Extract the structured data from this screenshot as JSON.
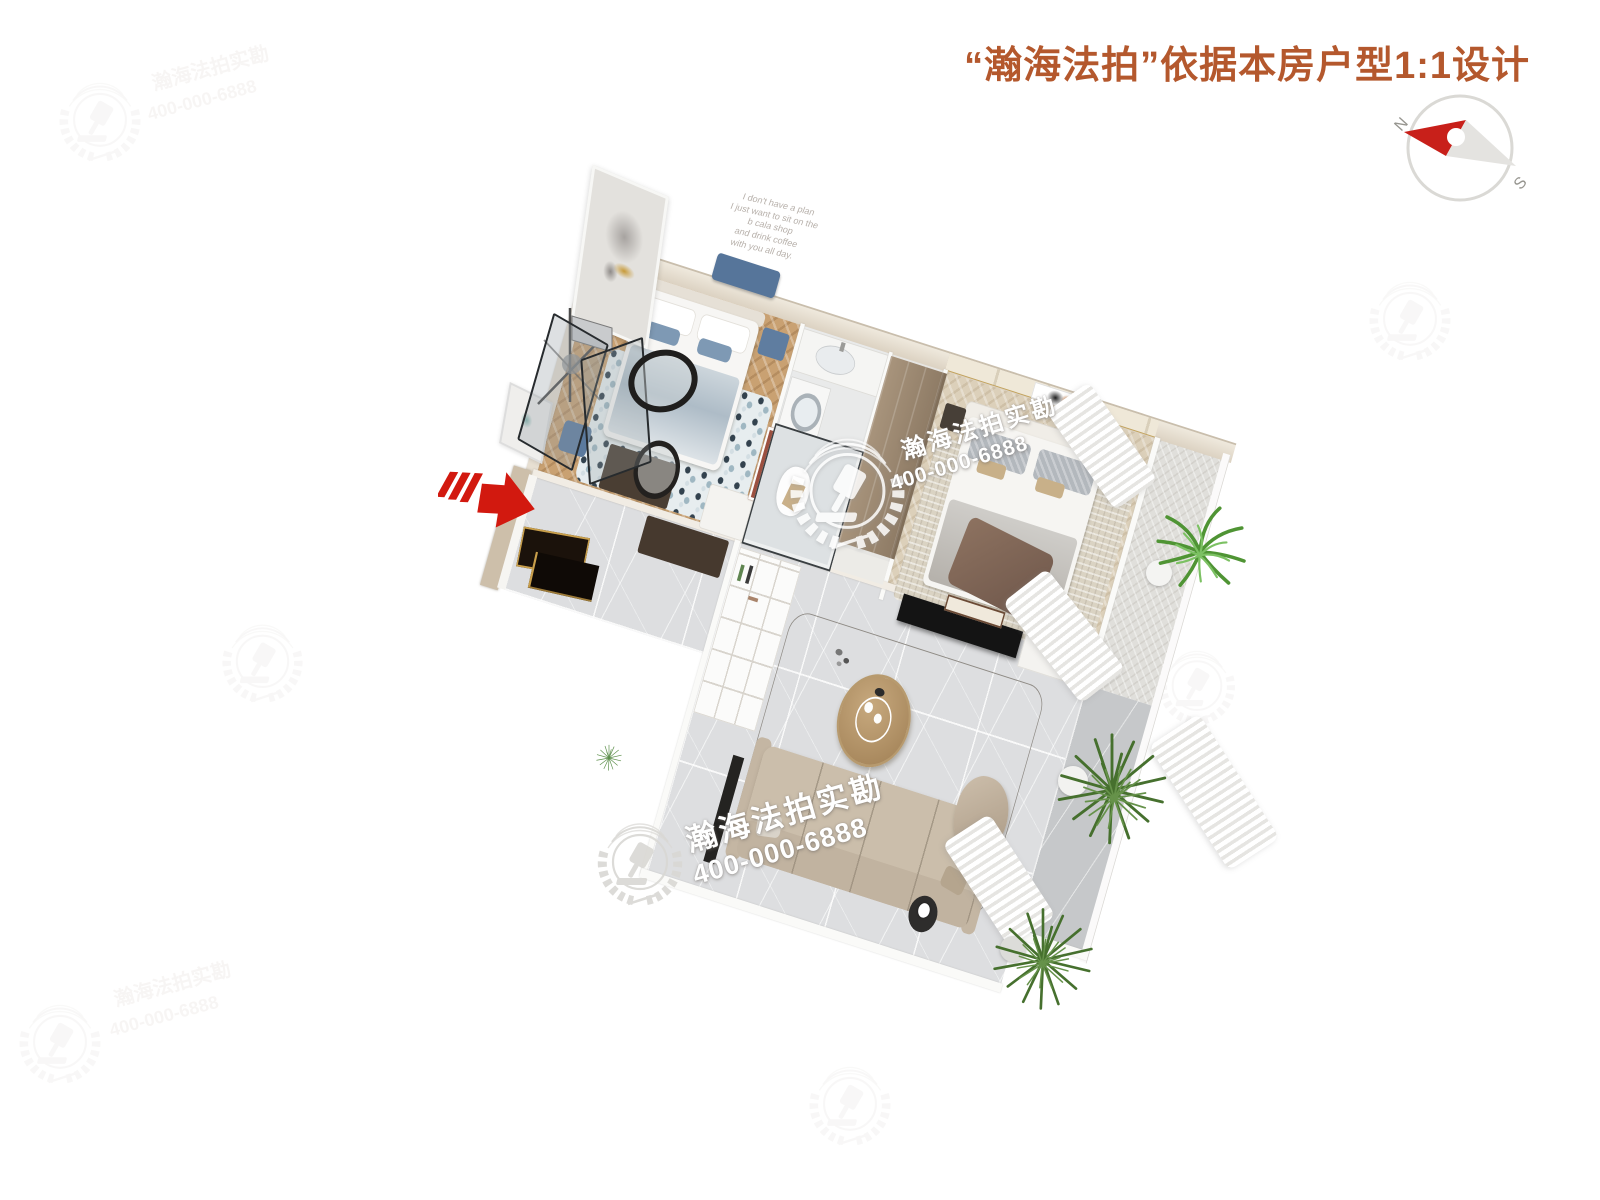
{
  "header": {
    "title": "“瀚海法拍”依据本房户型1:1设计"
  },
  "compass": {
    "north": "N",
    "south": "S"
  },
  "watermark": {
    "brand": "瀚海法拍实勘",
    "phone": "400-000-6888",
    "logo_icon": "gavel-laurel-wreath"
  },
  "wall_quote": {
    "lines": [
      "I don't have a plan",
      "I just want to sit on the",
      "b cala shop",
      "and drink coffee",
      "with you all day."
    ]
  },
  "colors": {
    "title_text": "#b4582d",
    "accent_red": "#d2190f",
    "compass_red": "#c8201a",
    "watermark_white": "#ffffff"
  }
}
